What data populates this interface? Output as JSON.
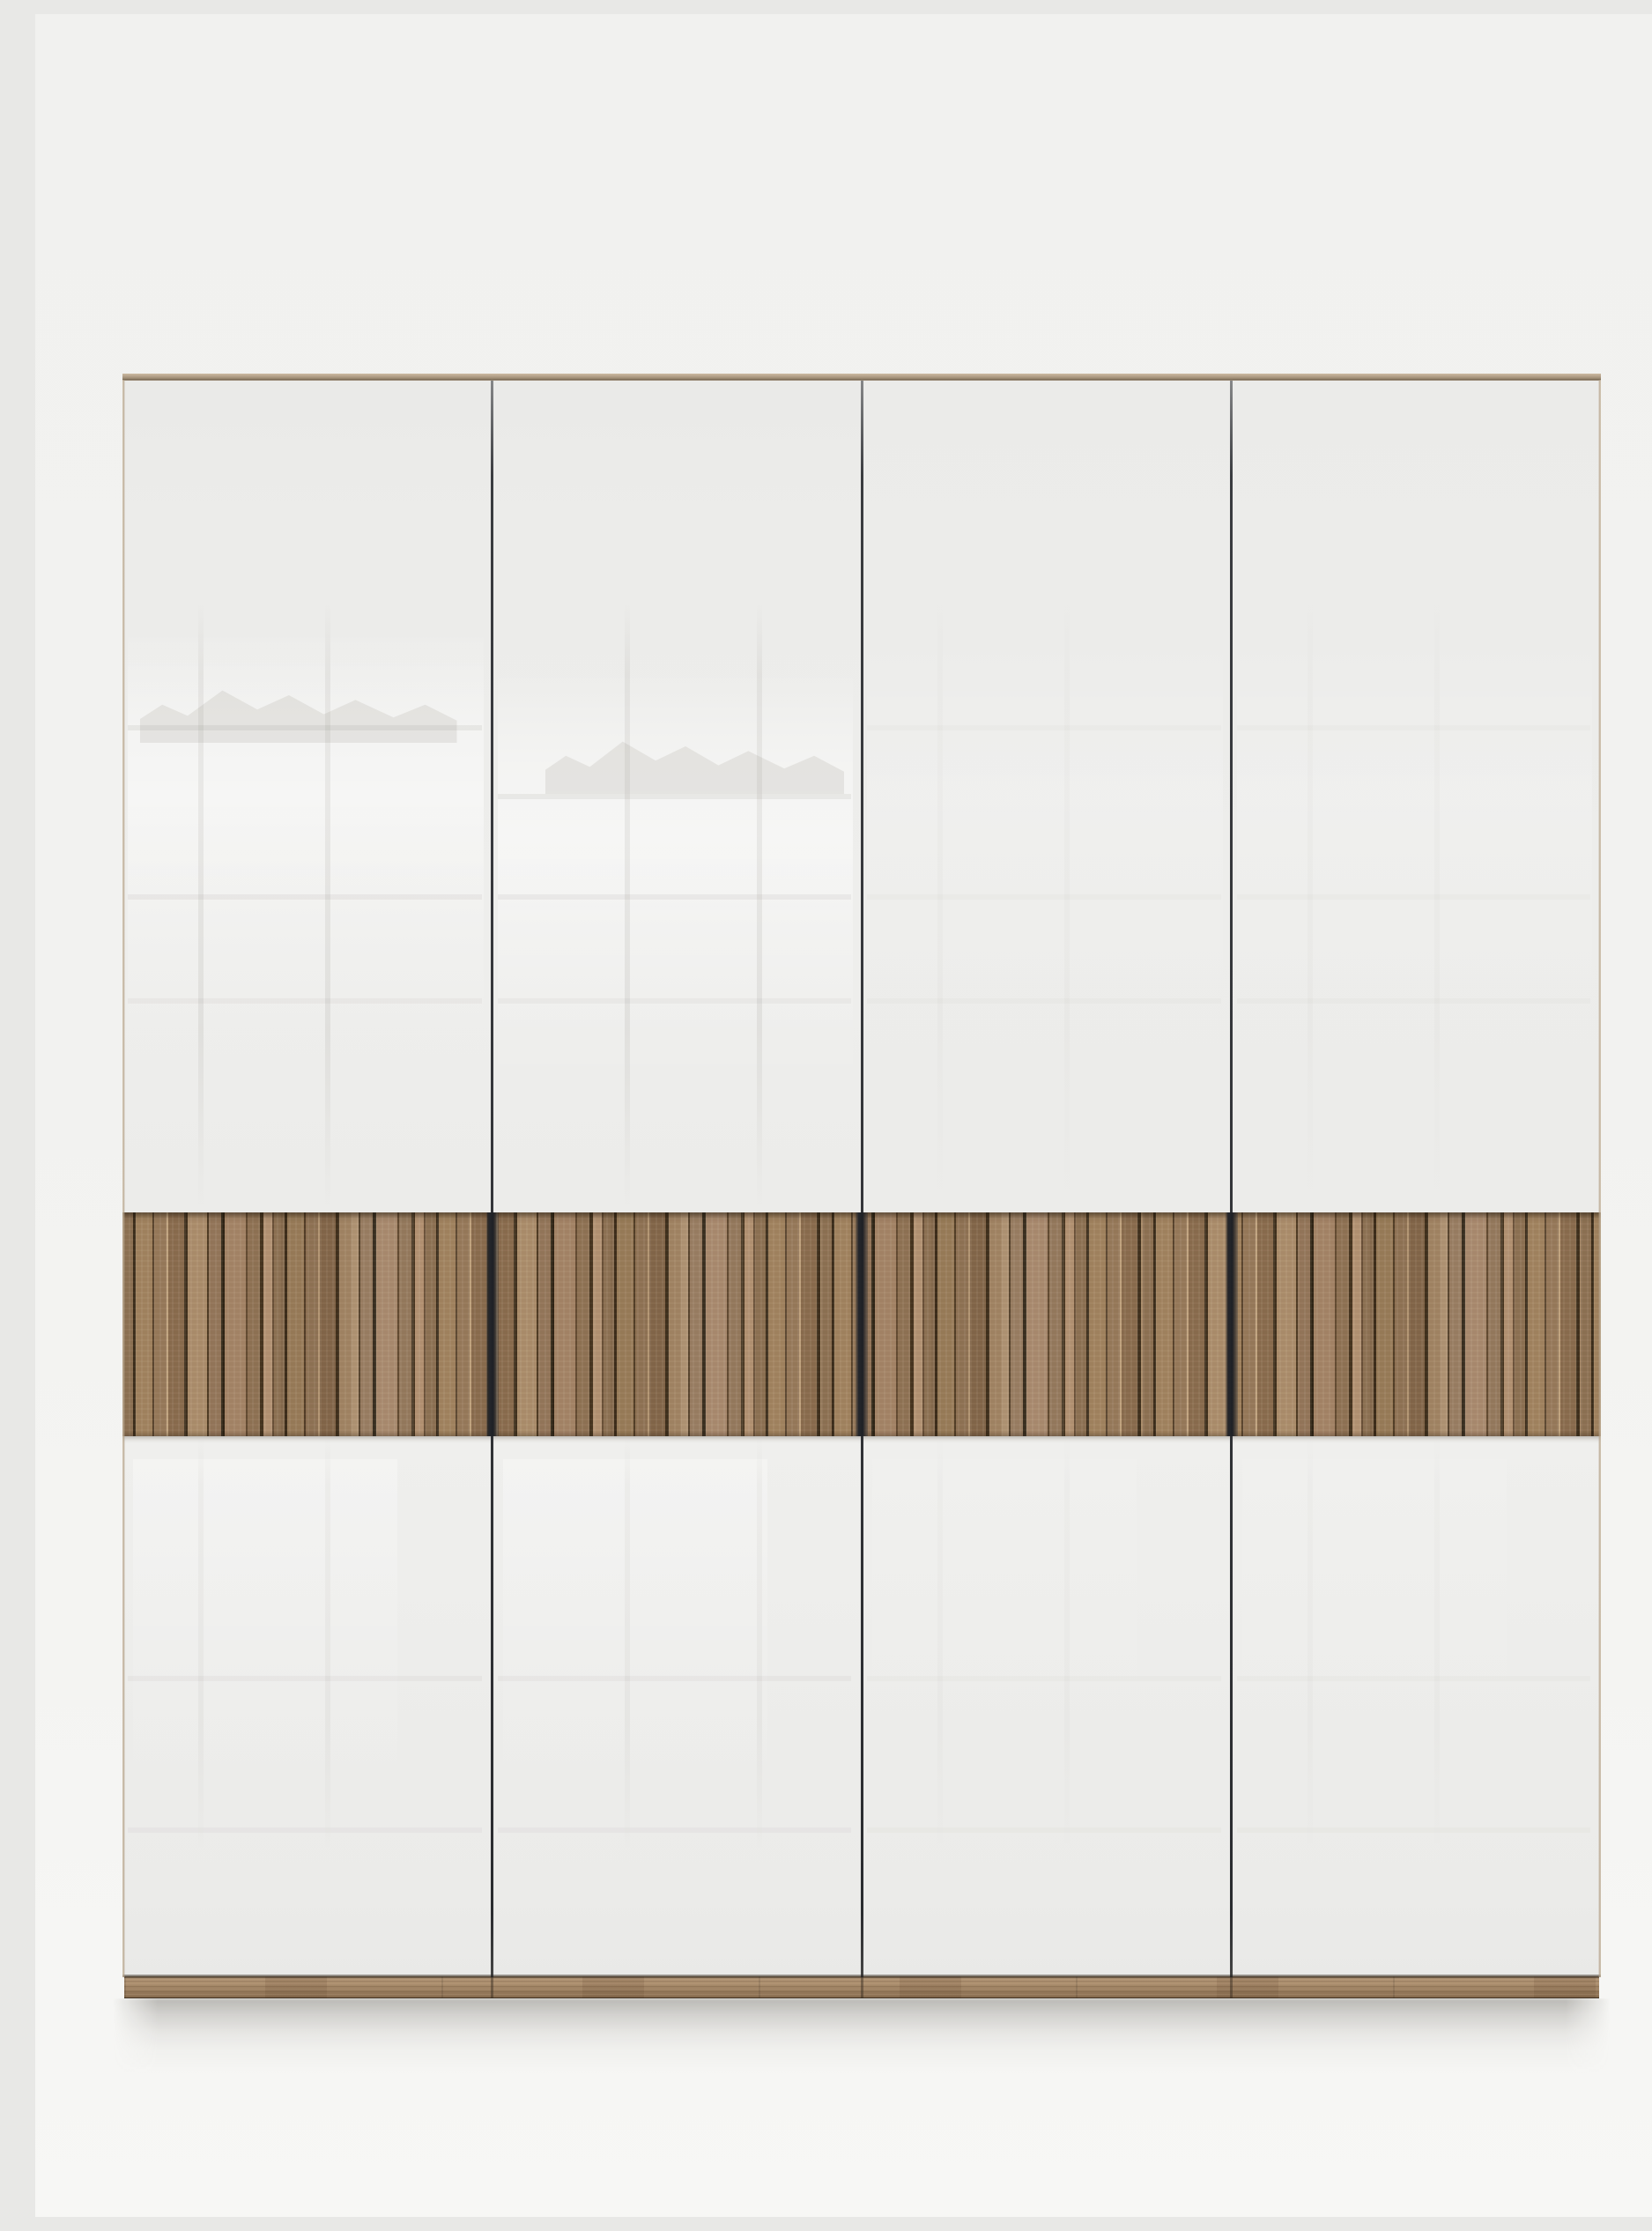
{
  "scene": {
    "type": "studio product photograph",
    "subject": "Four-door wardrobe with white gloss doors and oak-effect slatted centre band",
    "description": "Straight-on view of a tall four-door hinged wardrobe. Flat white gloss doors separated by narrow dark vertical gaps, a horizontal band of vertical oak-effect slats running across all four doors at waist height, a thin oak-effect top edge and an oak-effect plinth at the base. The unit stands against a plain light-grey studio backdrop; soft window reflections show in the glossy door fronts and a soft shadow falls on the floor beneath.",
    "door_count": 4,
    "gap_count": 3,
    "slat_band_position": "centre, waist height, spanning all doors",
    "visible_text": "none"
  },
  "colors": {
    "backdrop-top": "#f1f1ef",
    "backdrop-bottom": "#f7f7f5",
    "door-white": "#ededeb",
    "door-white-dim": "#e9e9e7",
    "gap-dark": "#34363a",
    "gap-wood-dark": "#24262b",
    "edge-tan": "#b3a089",
    "slat-base": "#9a7c5d",
    "slat-light": "#b39272",
    "groove-dark": "#3c2d1b",
    "plinth-base": "#a98c6c"
  }
}
